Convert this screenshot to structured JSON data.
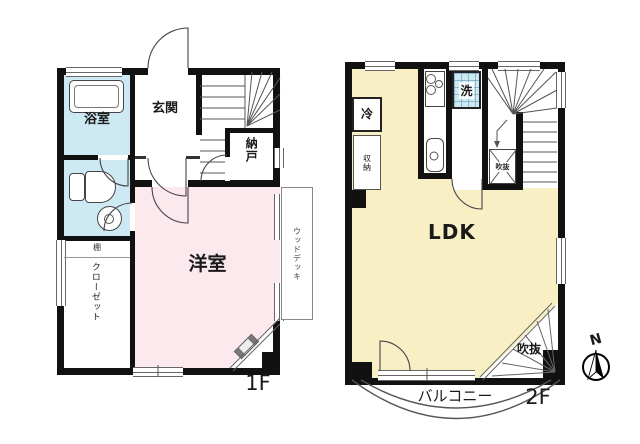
{
  "colors": {
    "wall": "#111111",
    "bath": "#cde9f3",
    "pink": "#fbe9ee",
    "yellow": "#f9efc4"
  },
  "floor1": {
    "floor_label": "1F",
    "bathroom_label": "浴室",
    "entrance_label": "玄関",
    "storeroom_label": "納戸",
    "western_room_label": "洋室",
    "closet_label": "クローゼット",
    "shelf_label": "棚",
    "wood_deck_label": "ウッドデッキ"
  },
  "floor2": {
    "floor_label": "2F",
    "ldk_label": "LDK",
    "refrigerator_label": "冷",
    "storage_label": "収納",
    "washer_label": "洗",
    "stair_void_label": "吹抜",
    "corner_void_label": "吹抜",
    "balcony_label": "バルコニー"
  },
  "compass": {
    "north_label": "N"
  }
}
